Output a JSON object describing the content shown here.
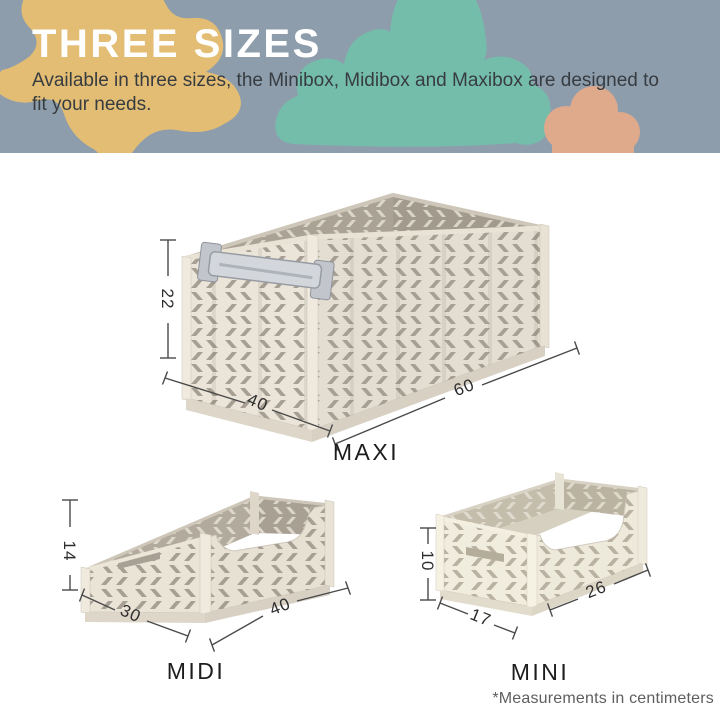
{
  "header": {
    "title": "THREE SIZES",
    "subtitle": "Available in three sizes, the Minibox, Midibox and Maxibox are designed to fit your needs.",
    "colors": {
      "background": "#8d9dac",
      "blob_yellow": "#e3bd73",
      "blob_teal": "#75bdab",
      "blob_orange": "#dfa98c",
      "title_text": "#ffffff",
      "subtitle_text": "#373c41"
    }
  },
  "crates": [
    {
      "name": "MAXI",
      "height_cm": "22",
      "width_cm": "40",
      "depth_cm": "60"
    },
    {
      "name": "MIDI",
      "height_cm": "14",
      "width_cm": "30",
      "depth_cm": "40"
    },
    {
      "name": "MINI",
      "height_cm": "10",
      "width_cm": "17",
      "depth_cm": "26"
    }
  ],
  "footnote": "*Measurements in centimeters",
  "crate_colors": {
    "maxi_body": "#e8e2d6",
    "maxi_slots": "#a79f93",
    "interior": "#aaa295",
    "mini_body": "#f1edde",
    "mini_slots": "#b9b1a1",
    "latch_metal": "#d3d6da"
  }
}
